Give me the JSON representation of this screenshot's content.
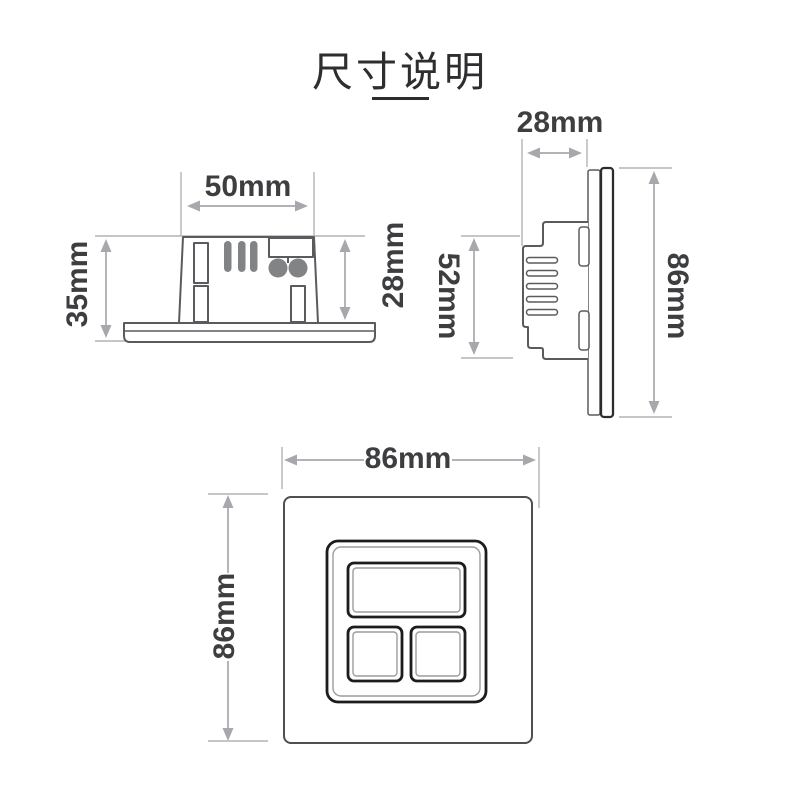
{
  "title": {
    "text": "尺寸说明"
  },
  "unit": "mm",
  "colors": {
    "outline": "#5a5b5e",
    "bezel": "#1c1c1e",
    "dimension_gray": "#a6a8ab",
    "label_text": "#3d3e40",
    "part_fill_gray": "#818385"
  },
  "views": {
    "side": {
      "name": "side view of mechanism on plate",
      "dims": {
        "width": "50mm",
        "height": "35mm",
        "depth": "28mm"
      }
    },
    "profile": {
      "name": "edge profile view of plate",
      "dims": {
        "depth": "28mm",
        "body_height": "52mm",
        "plate_height": "86mm"
      }
    },
    "front": {
      "name": "front view of panel",
      "dims": {
        "width": "86mm",
        "height": "86mm"
      }
    }
  }
}
